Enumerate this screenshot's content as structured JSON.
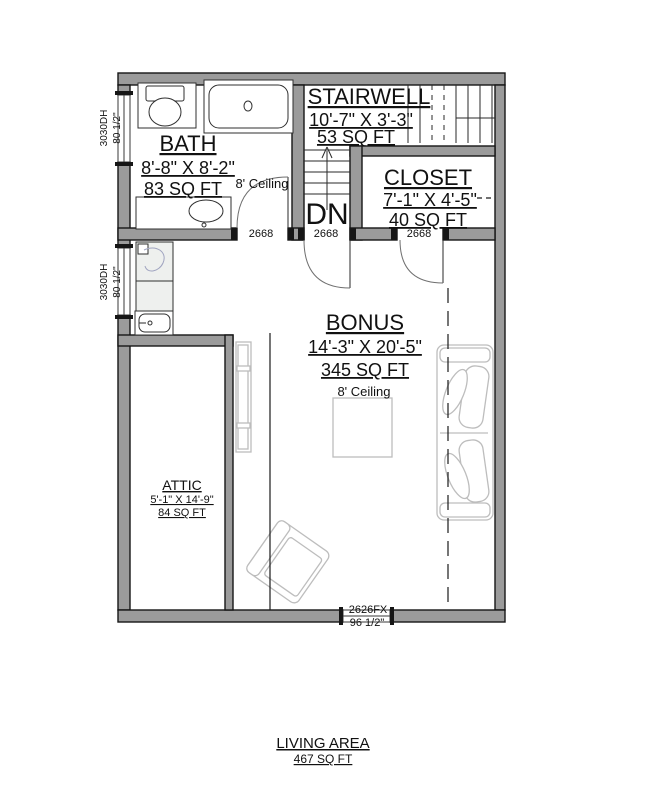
{
  "rooms": {
    "bath": {
      "name": "BATH",
      "dims": "8'-8\" X 8'-2\"",
      "area": "83 SQ FT",
      "ceiling": "8' Ceiling"
    },
    "stairwell": {
      "name": "STAIRWELL",
      "dims": "10'-7\" X 3'-3\"",
      "area": "53 SQ FT"
    },
    "closet": {
      "name": "CLOSET",
      "dims": "7'-1\" X 4'-5\"",
      "area": "40 SQ FT"
    },
    "bonus": {
      "name": "BONUS",
      "dims": "14'-3\" X 20'-5\"",
      "area": "345 SQ FT",
      "ceiling": "8' Ceiling"
    },
    "attic": {
      "name": "ATTIC",
      "dims": "5'-1\" X 14'-9\"",
      "area": "84 SQ FT"
    }
  },
  "stairs": {
    "down": "DN"
  },
  "labels": {
    "door1": "2668",
    "door2": "2668",
    "door3": "2668",
    "window_upper": {
      "size": "3030DH",
      "height": "80 1/2\""
    },
    "window_lower": {
      "size": "3030DH",
      "height": "80 1/2\""
    },
    "window_bottom": {
      "size": "2626FX",
      "width": "96 1/2\""
    }
  },
  "footer": {
    "title": "LIVING AREA",
    "area": "467 SQ FT"
  },
  "colors": {
    "walls": "#9b9b9b",
    "lines": "#1a1a1a",
    "furniture": "#bdbdbd",
    "fixture_fill": "#eef0ee",
    "background": "#ffffff"
  }
}
